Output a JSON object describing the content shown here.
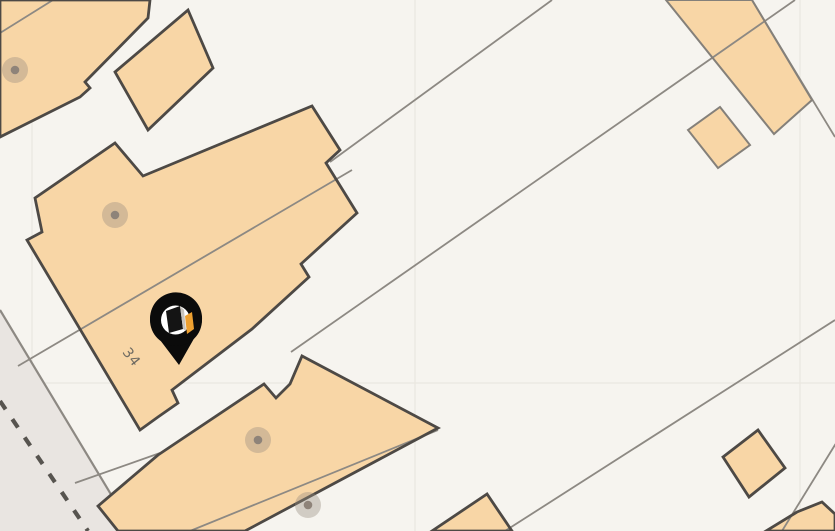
{
  "map": {
    "kind": "cadastral-map",
    "canvas": {
      "width": 835,
      "height": 531
    },
    "colors": {
      "background": "#f6f4ef",
      "tile_grid_line": "#eae7e0",
      "building_fill": "#f8d6a6",
      "building_stroke": "#4d4945",
      "light_building_stroke": "#84807a",
      "parcel_line": "#8d8983",
      "road_fill": "#e9e5e1",
      "road_edge": "#8d8983",
      "road_dash": "#57544f",
      "dot_outer": "rgba(150,140,126,0.38)",
      "dot_inner": "#8e8379",
      "label_text": "#6f6b62",
      "pin_body": "#0b0b0b",
      "pin_inner": "#ffffff",
      "pin_logo_dark": "#141414",
      "pin_logo_side": "#c8c4be",
      "pin_logo_accent": "#eda031"
    },
    "tile_grid": {
      "verticals": [
        32,
        415,
        800
      ],
      "horizontals": [
        383
      ]
    },
    "road": {
      "fill_polygon": [
        [
          0,
          310
        ],
        [
          133,
          531
        ],
        [
          0,
          531
        ]
      ],
      "edge_line": {
        "x1": 0,
        "y1": 310,
        "x2": 133,
        "y2": 531
      },
      "dashed_line": {
        "x1": 0,
        "y1": 401,
        "x2": 88,
        "y2": 531,
        "dash": "10 12",
        "width": 4.2
      }
    },
    "buildings_dark": [
      {
        "id": "building-top-left",
        "points": [
          [
            0,
            0
          ],
          [
            150,
            0
          ],
          [
            148,
            18
          ],
          [
            85,
            82
          ],
          [
            90,
            88
          ],
          [
            80,
            97
          ],
          [
            0,
            137
          ]
        ]
      },
      {
        "id": "building-small-top",
        "points": [
          [
            188,
            10
          ],
          [
            213,
            68
          ],
          [
            148,
            130
          ],
          [
            115,
            72
          ]
        ]
      },
      {
        "id": "building-34",
        "points": [
          [
            115,
            143
          ],
          [
            143,
            176
          ],
          [
            312,
            106
          ],
          [
            340,
            150
          ],
          [
            326,
            163
          ],
          [
            357,
            213
          ],
          [
            301,
            264
          ],
          [
            309,
            277
          ],
          [
            252,
            329
          ],
          [
            172,
            390
          ],
          [
            178,
            403
          ],
          [
            158,
            417
          ],
          [
            140,
            430
          ],
          [
            27,
            240
          ],
          [
            42,
            232
          ],
          [
            35,
            198
          ]
        ]
      },
      {
        "id": "building-lower-left",
        "points": [
          [
            158,
            455
          ],
          [
            264,
            384
          ],
          [
            276,
            398
          ],
          [
            290,
            384
          ],
          [
            302,
            356
          ],
          [
            438,
            428
          ],
          [
            245,
            531
          ],
          [
            118,
            531
          ],
          [
            98,
            506
          ]
        ]
      },
      {
        "id": "building-bottom-center",
        "points": [
          [
            487,
            494
          ],
          [
            432,
            531
          ],
          [
            512,
            531
          ]
        ]
      },
      {
        "id": "building-bottom-right",
        "points": [
          [
            797,
            512
          ],
          [
            822,
            502
          ],
          [
            835,
            514
          ],
          [
            835,
            531
          ],
          [
            766,
            531
          ]
        ]
      },
      {
        "id": "building-square-br",
        "points": [
          [
            723,
            457
          ],
          [
            758,
            430
          ],
          [
            785,
            468
          ],
          [
            749,
            497
          ]
        ]
      }
    ],
    "buildings_light": [
      {
        "id": "band-top-right",
        "points": [
          [
            666,
            0
          ],
          [
            752,
            0
          ],
          [
            812,
            100
          ],
          [
            774,
            134
          ]
        ]
      },
      {
        "id": "square-top-right",
        "points": [
          [
            688,
            130
          ],
          [
            720,
            107
          ],
          [
            750,
            145
          ],
          [
            718,
            168
          ]
        ]
      }
    ],
    "parcel_lines": [
      {
        "x1": 0,
        "y1": 33,
        "x2": 53,
        "y2": 0
      },
      {
        "x1": 552,
        "y1": 0,
        "x2": 330,
        "y2": 162
      },
      {
        "x1": 795,
        "y1": 0,
        "x2": 291,
        "y2": 352
      },
      {
        "x1": 352,
        "y1": 170,
        "x2": 18,
        "y2": 366
      },
      {
        "x1": 835,
        "y1": 320,
        "x2": 505,
        "y2": 531
      },
      {
        "x1": 438,
        "y1": 430,
        "x2": 190,
        "y2": 531
      },
      {
        "x1": 75,
        "y1": 483,
        "x2": 160,
        "y2": 453
      },
      {
        "x1": 838,
        "y1": 440,
        "x2": 782,
        "y2": 531
      },
      {
        "x1": 752,
        "y1": 0,
        "x2": 835,
        "y2": 137
      }
    ],
    "address_points": {
      "outer_radius": 13,
      "inner_radius": 4.3,
      "points": [
        [
          15,
          70
        ],
        [
          115,
          215
        ],
        [
          258,
          440
        ],
        [
          308,
          505
        ]
      ]
    },
    "parcel_label": {
      "text": "34",
      "x": 128,
      "y": 360,
      "rotation": 52,
      "font_size": 14
    },
    "pin": {
      "cx": 176,
      "cy": 320,
      "head_radius": 26,
      "inner_radius": 14.5,
      "tip": [
        179,
        365
      ],
      "logo_dark_points": [
        [
          166,
          311
        ],
        [
          180,
          306
        ],
        [
          183,
          329
        ],
        [
          169,
          333
        ]
      ],
      "logo_side_points": [
        [
          180,
          306
        ],
        [
          184,
          310
        ],
        [
          186,
          331
        ],
        [
          183,
          329
        ]
      ],
      "logo_accent_points": [
        [
          185,
          316
        ],
        [
          192,
          312
        ],
        [
          194,
          329
        ],
        [
          187,
          334
        ]
      ]
    }
  }
}
